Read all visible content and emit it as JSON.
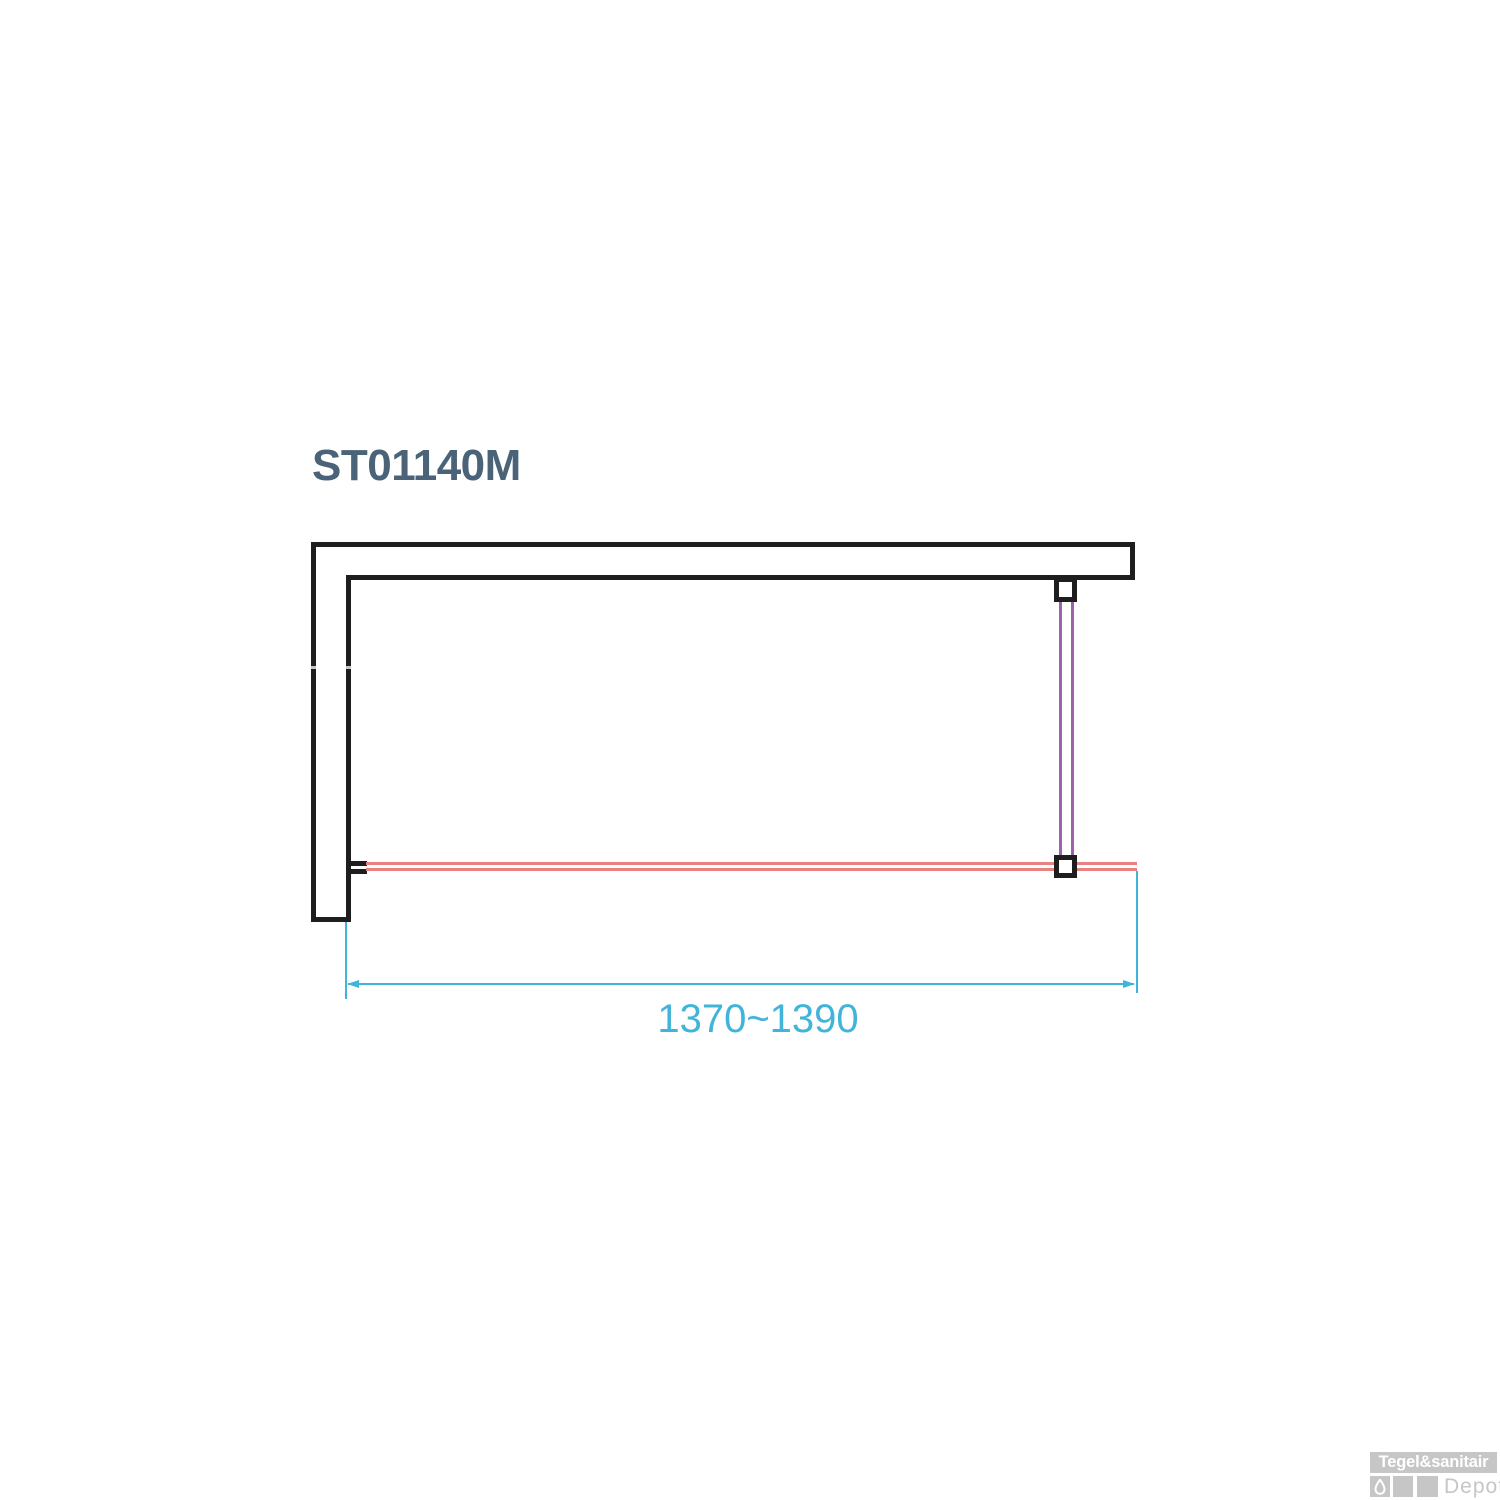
{
  "title": "ST01140M",
  "dimension": {
    "label": "1370~1390"
  },
  "watermark": {
    "brand": "Tegel&sanitair",
    "suffix": "Depot"
  },
  "colors": {
    "wall": "#1e1e1e",
    "glass": "#ea8181",
    "stabilizer": "#9c63ac",
    "dimension": "#41b4da",
    "title": "#4a6378",
    "logo_gray": "#c6c6c6"
  },
  "diagram": {
    "type": "technical-top-view",
    "description_parts": {
      "wall": "L-shaped wall, top and left",
      "glass_panel": "fixed glass panel along bottom, wall-mounted at left",
      "stabilizer_bar": "support bar from top wall to glass panel",
      "dimension_span_mm": "1370~1390"
    }
  }
}
